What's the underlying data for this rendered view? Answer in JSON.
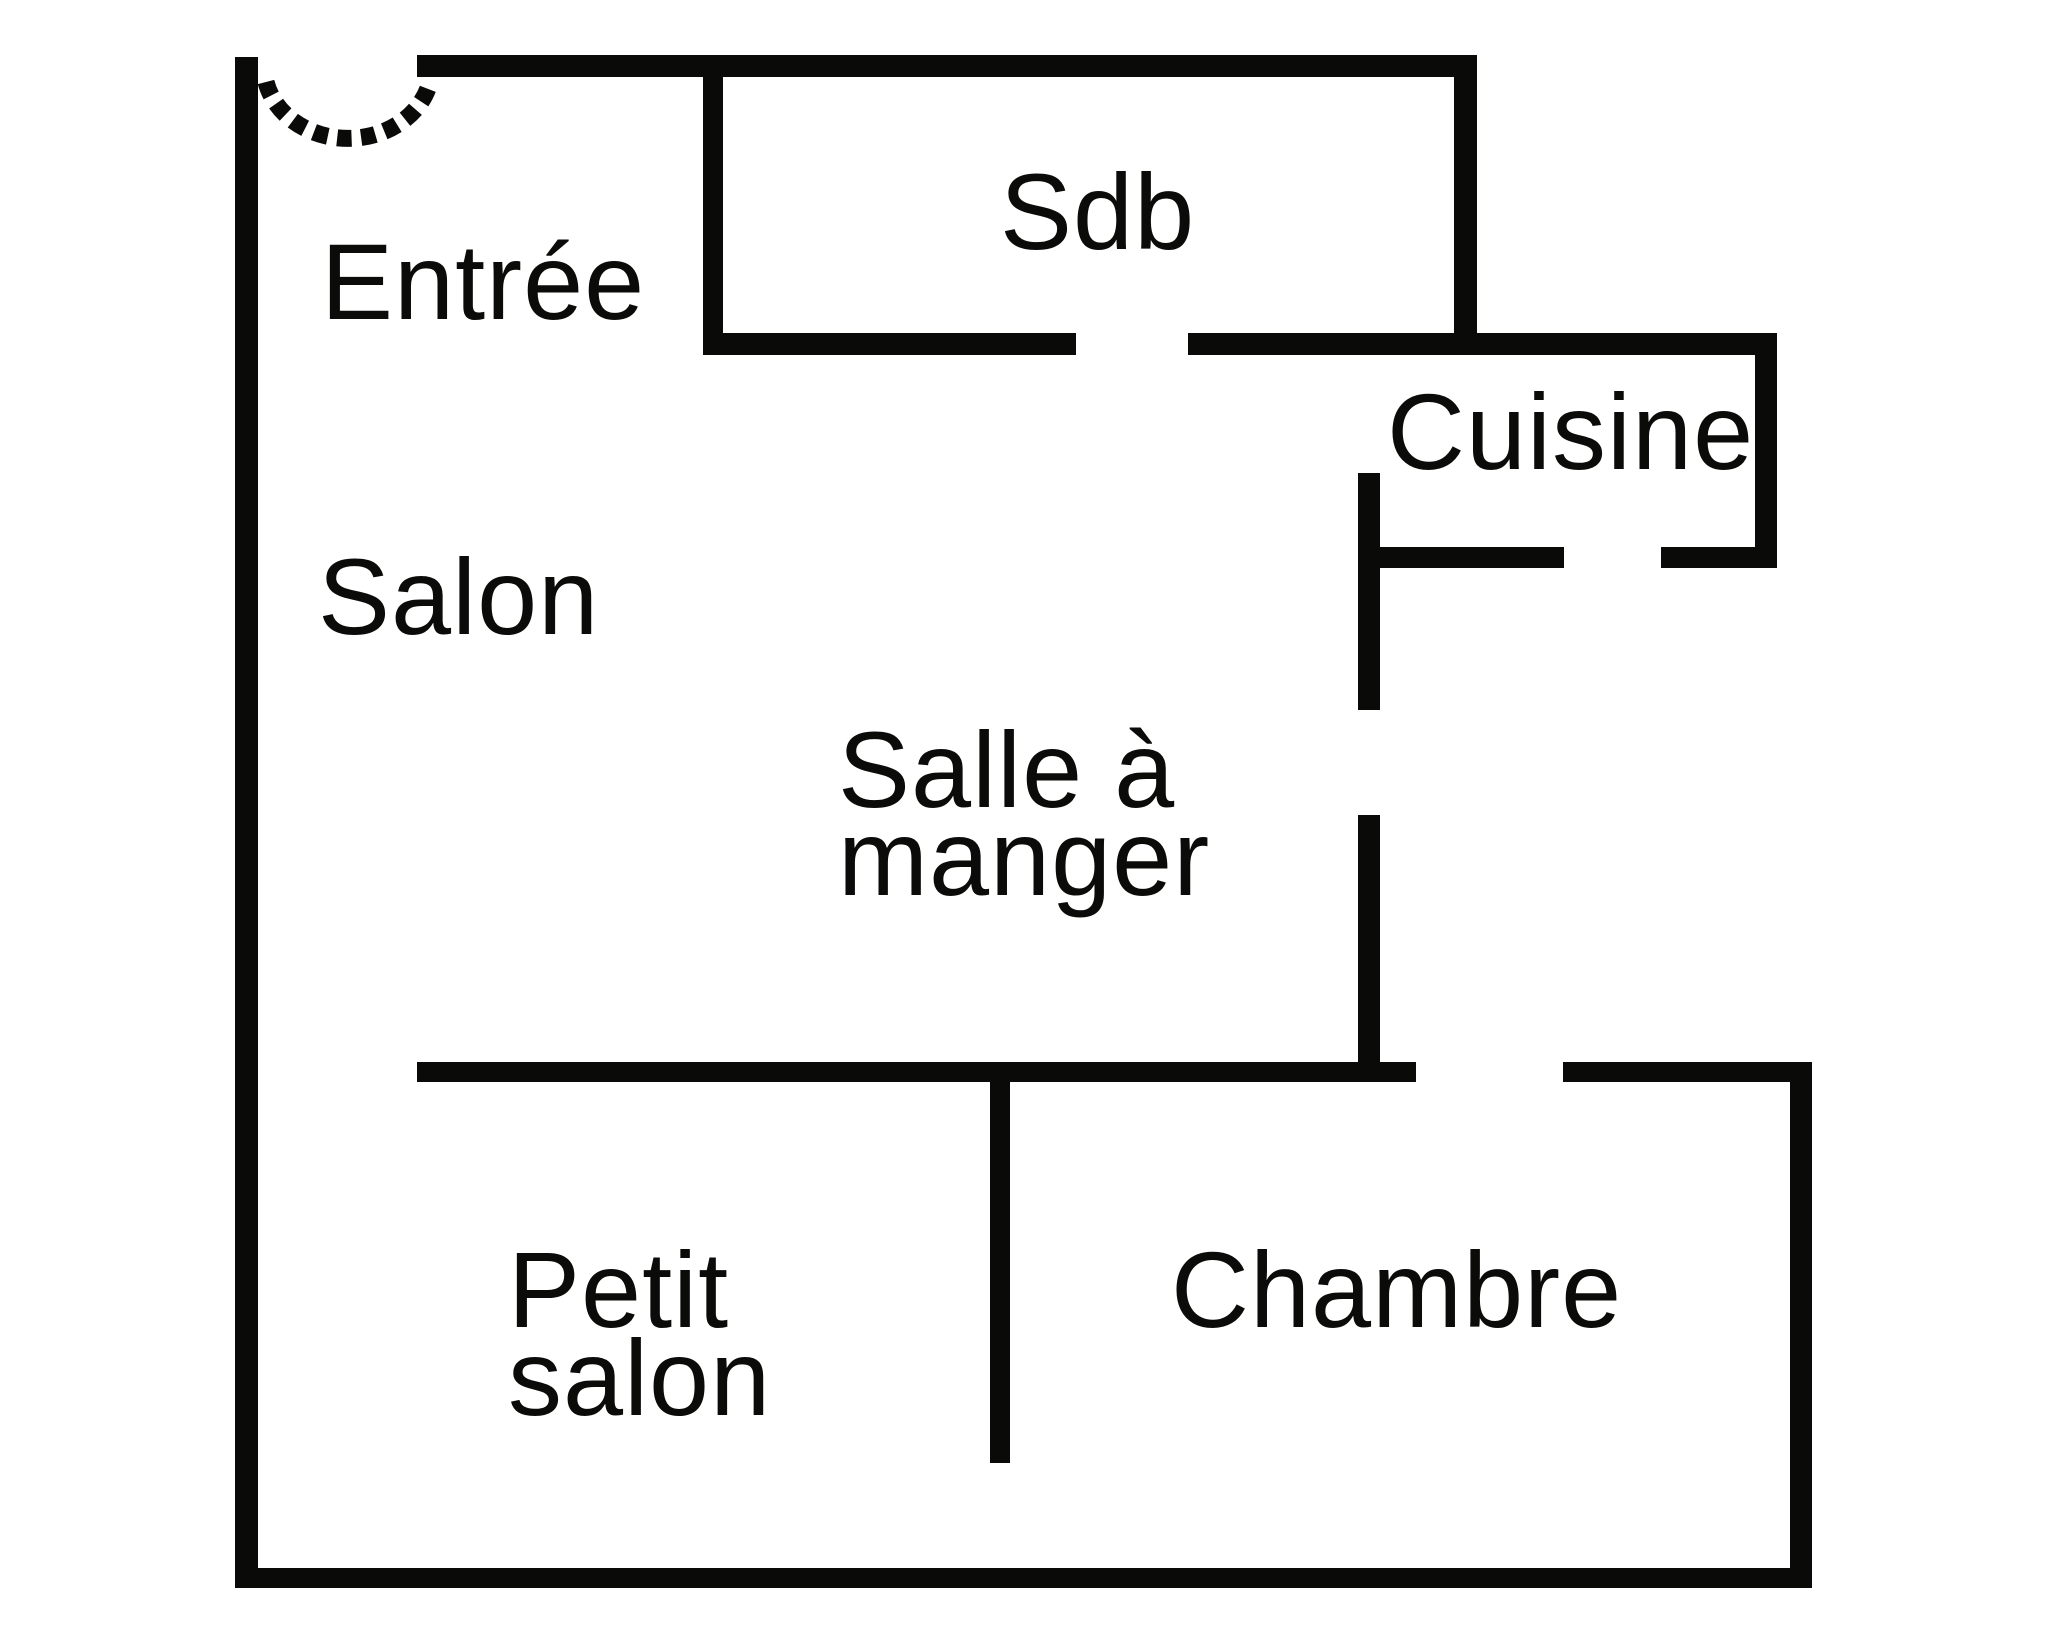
{
  "title": "Plan d'appartement",
  "colors": {
    "wall": "#0a0a09",
    "background": "#ffffff",
    "text": "#0b0b0a"
  },
  "rooms": {
    "entree": {
      "label": "Entrée"
    },
    "sdb": {
      "label": "Sdb"
    },
    "cuisine": {
      "label": "Cuisine"
    },
    "salon": {
      "label": "Salon"
    },
    "salle_a_manger": {
      "label": "Salle à\nmanger"
    },
    "petit_salon": {
      "label": "Petit\nsalon"
    },
    "chambre": {
      "label": "Chambre"
    }
  },
  "icons": {
    "door_swing": "dashed quarter-turn door swing arc at entrance"
  }
}
